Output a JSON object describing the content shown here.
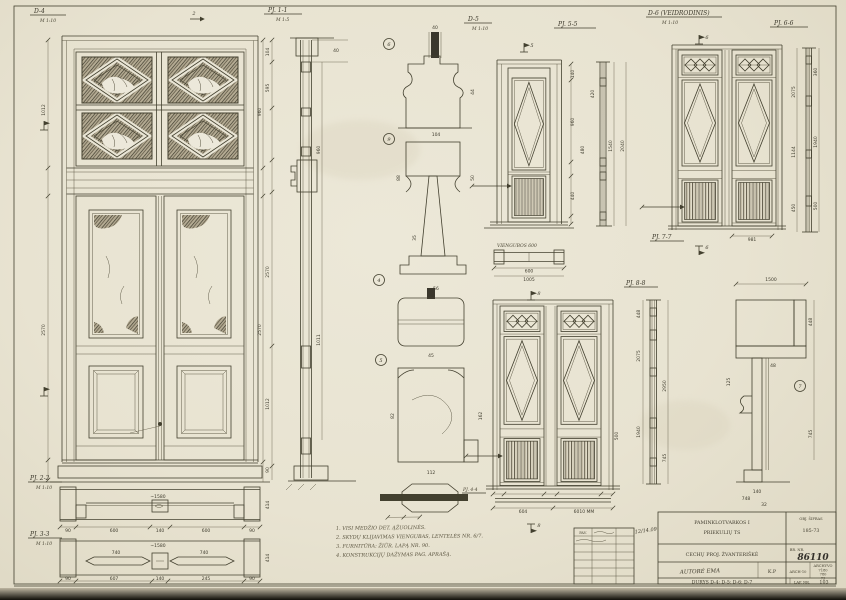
{
  "colors": {
    "paper": "#e8e3d1",
    "ink": "#43402f"
  },
  "sheet_labels": {
    "d4": "D-4",
    "d4_scale": "M 1:10",
    "pj11": "PJ. 1-1",
    "pj11_scale": "M 1:5",
    "pj22": "PJ. 2-2",
    "pj22_scale": "M 1:10",
    "pj33": "PJ. 3-3",
    "pj33_scale": "M 1:10",
    "d5": "D-5",
    "d5_scale": "M 1:10",
    "pj55": "PJ. 5-5",
    "d6": "D-6 (VEIDRODINIS)",
    "d6_scale": "M 1:10",
    "pj66": "PJ. 6-6",
    "pj77": "PJ. 7-7",
    "pj88": "PJ. 8-8",
    "pj44": "PJ. 4-4",
    "d5_plan": "VIENGUBOS 600"
  },
  "markers": {
    "s2": "2",
    "s5": "5",
    "s6": "6",
    "s8": "8",
    "c4": "4",
    "c5": "5",
    "c6": "6",
    "c7": "7",
    "c9": "9"
  },
  "dims": {
    "plan1": [
      "~1580",
      "600",
      "140",
      "600",
      "90",
      "90",
      "414"
    ],
    "plan2": [
      "~1580",
      "740",
      "740",
      "90",
      "607",
      "140",
      "245",
      "414"
    ],
    "vsec": [
      "2570",
      "1012",
      "595",
      "104",
      "40",
      "90",
      "960",
      "1011"
    ],
    "details": [
      "40",
      "104",
      "44",
      "50",
      "88",
      "56",
      "35",
      "162",
      "82",
      "45",
      "112"
    ],
    "d5": [
      "960",
      "440",
      "480",
      "140",
      "1540",
      "2040",
      "420",
      "600",
      "1005"
    ],
    "d6": [
      "2075",
      "1144",
      "450",
      "1940",
      "500",
      "360",
      "981"
    ],
    "lower": [
      "604",
      "6010 MM",
      "500"
    ],
    "corner": [
      "1500",
      "448",
      "745",
      "140",
      "125",
      "48",
      "748",
      "32"
    ],
    "rstrip": [
      "2075",
      "448",
      "1940",
      "745",
      "2950"
    ]
  },
  "notes": {
    "n1": "1. VISI MEDŽIO DET. ĄŽUOLINĖS.",
    "n2": "2. SKYDŲ KLIJAVIMAS VIENGUBAS, LENTELĖS NR. 6/7.",
    "n3": "3. FURNITŪRA: ŽIŪR. LAPĄ NR. 90.",
    "n4": "4. KONSTRUKCIJŲ DAŽYMAS PAG. APRAŠĄ."
  },
  "titleblock": {
    "org_line1": "PAMINKLOTVARKOS I",
    "org_line2": "PRIEKULIŲ TS",
    "obj_label": "OBJ. ŠIFRAS",
    "obj_value": "185-73",
    "object_name": "CECHŲ PROJ. ŽVANTERIŠKĖ",
    "brnr_label": "BR. NR.",
    "brnr_value": "86110",
    "author": "AUTORĖ EMA",
    "stage": "K.P",
    "code": "ARCH-10",
    "rev_header": "ARCHYVO",
    "rev1": "7180",
    "rev2": "780",
    "rev3": "73",
    "content": "DURYS D-4; D-5; D-6; D-7",
    "lap_label": "LAP. NR.",
    "lap_value": "103",
    "date_scrawl": "12/14.09",
    "grid_header": "PAV."
  }
}
